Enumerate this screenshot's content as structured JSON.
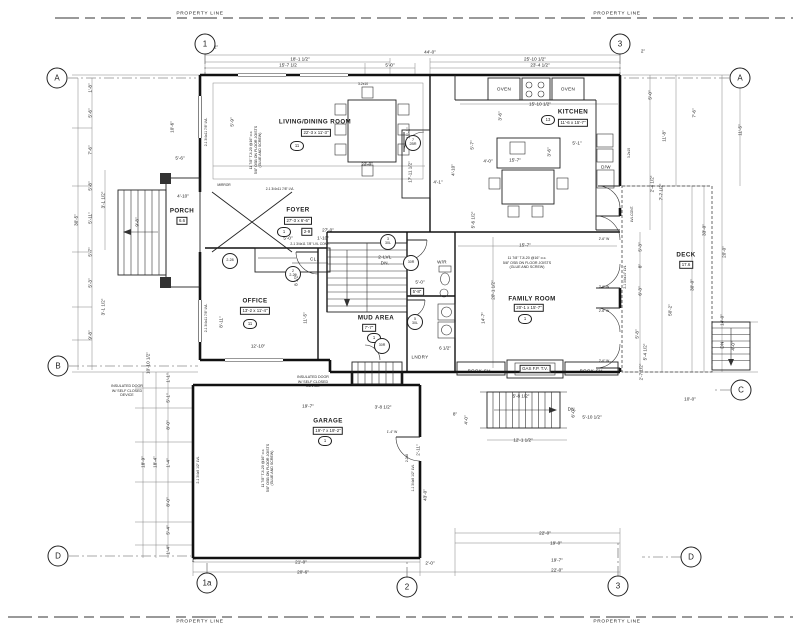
{
  "property_line_label": "PROPERTY LINE",
  "grid_bubbles": [
    {
      "id": "1",
      "x": 205,
      "y": 44
    },
    {
      "id": "3",
      "x": 620,
      "y": 44
    },
    {
      "id": "A",
      "x": 57,
      "y": 78
    },
    {
      "id": "A",
      "x": 740,
      "y": 78
    },
    {
      "id": "B",
      "x": 58,
      "y": 366
    },
    {
      "id": "C",
      "x": 741,
      "y": 390
    },
    {
      "id": "D",
      "x": 58,
      "y": 556
    },
    {
      "id": "D",
      "x": 691,
      "y": 557
    },
    {
      "id": "1a",
      "x": 207,
      "y": 583
    },
    {
      "id": "2",
      "x": 407,
      "y": 587
    },
    {
      "id": "3",
      "x": 618,
      "y": 586
    }
  ],
  "labels": [
    {
      "t": "LIVING/DINING ROOM",
      "x": 315,
      "y": 122,
      "k": "room",
      "n": "room-label-living-dining"
    },
    {
      "t": "22'-3 x 11'-3\"",
      "x": 316,
      "y": 133,
      "k": "box"
    },
    {
      "t": "11",
      "x": 297,
      "y": 146,
      "k": "hex"
    },
    {
      "t": "KITCHEN",
      "x": 573,
      "y": 112,
      "k": "room",
      "n": "room-label-kitchen"
    },
    {
      "t": "11'-6 x 15'-7\"",
      "x": 573,
      "y": 123,
      "k": "box"
    },
    {
      "t": "13",
      "x": 548,
      "y": 120,
      "k": "hex"
    },
    {
      "t": "FOYER",
      "x": 298,
      "y": 210,
      "k": "room",
      "n": "room-label-foyer"
    },
    {
      "t": "27'-3 x 6'-6\"",
      "x": 298,
      "y": 221,
      "k": "box"
    },
    {
      "t": "1",
      "x": 284,
      "y": 232,
      "k": "hex"
    },
    {
      "t": "2-9",
      "x": 307,
      "y": 232,
      "k": "box"
    },
    {
      "t": "OFFICE",
      "x": 255,
      "y": 301,
      "k": "room",
      "n": "room-label-office"
    },
    {
      "t": "13'-2 x 11'-4\"",
      "x": 255,
      "y": 311,
      "k": "box"
    },
    {
      "t": "11",
      "x": 250,
      "y": 324,
      "k": "hex"
    },
    {
      "t": "MUD AREA",
      "x": 376,
      "y": 318,
      "k": "room",
      "n": "room-label-mud-area"
    },
    {
      "t": "7'-7\"",
      "x": 369,
      "y": 328,
      "k": "box"
    },
    {
      "t": "1",
      "x": 374,
      "y": 338,
      "k": "hex"
    },
    {
      "t": "FAMILY ROOM",
      "x": 532,
      "y": 299,
      "k": "room",
      "n": "room-label-family-room"
    },
    {
      "t": "20'-1 x 15'-7\"",
      "x": 529,
      "y": 308,
      "k": "box"
    },
    {
      "t": "1",
      "x": 525,
      "y": 319,
      "k": "hex"
    },
    {
      "t": "GARAGE",
      "x": 328,
      "y": 421,
      "k": "room",
      "n": "room-label-garage"
    },
    {
      "t": "19'-7 x 19'-2\"",
      "x": 328,
      "y": 431,
      "k": "box"
    },
    {
      "t": "1",
      "x": 325,
      "y": 441,
      "k": "hex"
    },
    {
      "t": "DECK",
      "x": 686,
      "y": 255,
      "k": "room",
      "n": "room-label-deck"
    },
    {
      "t": "17.6",
      "x": 686,
      "y": 265,
      "k": "box"
    },
    {
      "t": "PORCH",
      "x": 182,
      "y": 211,
      "k": "room",
      "n": "room-label-porch"
    },
    {
      "t": "6.6",
      "x": 182,
      "y": 221,
      "k": "box"
    },
    {
      "t": "W/R",
      "x": 442,
      "y": 262,
      "k": "fix",
      "n": "room-label-washroom"
    },
    {
      "t": "LNDRY",
      "x": 420,
      "y": 357,
      "k": "fix",
      "n": "room-label-laundry"
    },
    {
      "t": "CL.",
      "x": 314,
      "y": 259,
      "k": "fix",
      "n": "closet-label"
    },
    {
      "t": "OVEN",
      "x": 504,
      "y": 89,
      "k": "fix",
      "n": "oven-label"
    },
    {
      "t": "OVEN",
      "x": 568,
      "y": 89,
      "k": "fix",
      "n": "oven-label"
    },
    {
      "t": "D/W",
      "x": 606,
      "y": 167,
      "k": "fix",
      "n": "dishwasher-label"
    },
    {
      "t": "BOOK SH.",
      "x": 480,
      "y": 371,
      "k": "fix",
      "n": "bookshelf-label"
    },
    {
      "t": "GAS F.P. T.V.",
      "x": 535,
      "y": 369,
      "k": "box",
      "n": "fireplace-label"
    },
    {
      "t": "BOOK SH.",
      "x": 592,
      "y": 371,
      "k": "fix",
      "n": "bookshelf-label"
    },
    {
      "t": "MIRROR",
      "x": 224,
      "y": 186,
      "k": "tiny"
    },
    {
      "t": "2-LVL\nDN.",
      "x": 385,
      "y": 260,
      "k": "fix",
      "n": "stair-label"
    },
    {
      "t": "DN.",
      "x": 572,
      "y": 409,
      "k": "fix",
      "n": "stair-label"
    },
    {
      "t": "DN",
      "x": 722,
      "y": 345,
      "r": -90,
      "k": "fix",
      "n": "deck-stair-label"
    },
    {
      "t": "7\n2BR",
      "x": 413,
      "y": 143,
      "k": "tag",
      "n": "door-tag"
    },
    {
      "t": "2-28",
      "x": 230,
      "y": 261,
      "k": "tag",
      "n": "door-tag"
    },
    {
      "t": "2\n2-29",
      "x": 293,
      "y": 274,
      "k": "tag",
      "n": "door-tag"
    },
    {
      "t": "3\n30L",
      "x": 388,
      "y": 242,
      "k": "tag",
      "n": "door-tag"
    },
    {
      "t": "30R",
      "x": 411,
      "y": 263,
      "k": "tag",
      "n": "door-tag"
    },
    {
      "t": "5\n30L",
      "x": 415,
      "y": 322,
      "k": "tag",
      "n": "door-tag"
    },
    {
      "t": "30R",
      "x": 382,
      "y": 346,
      "k": "tag",
      "n": "door-tag"
    },
    {
      "t": "11 7/8\" TJI-20 @16\" o.c.\n5/8\" OSB ON FLOOR JOISTS\n(GLUE AND SCREW)",
      "x": 527,
      "y": 263,
      "k": "note",
      "n": "floor-joist-note"
    },
    {
      "t": "11 7/8\" TJI-20 @16\" o.c.\n5/8\" OSB ON FLOOR JOISTS\n(GLUE AND SCREW)",
      "x": 256,
      "y": 150,
      "r": -90,
      "k": "note",
      "n": "floor-joist-note"
    },
    {
      "t": "11 7/8\" TJI-20 @16\" o.c.\n5/8\" OSB ON FLOOR JOISTS\n(GLUE AND SCREW)",
      "x": 268,
      "y": 468,
      "r": -90,
      "k": "note",
      "n": "floor-joist-note"
    },
    {
      "t": "INSULATED DOOR\nW/ SELF CLOSED\nDEVICE",
      "x": 127,
      "y": 391,
      "k": "note",
      "n": "insulated-door-note"
    },
    {
      "t": "INSULATED DOOR\nW/ SELF CLOSED\nDEVICE",
      "x": 313,
      "y": 382,
      "k": "note",
      "n": "insulated-door-note"
    },
    {
      "t": "2-1 3/4x11 7/8\" LVL",
      "x": 280,
      "y": 190,
      "k": "tiny"
    },
    {
      "t": "2-1 3/4x11 7/8\" LVL CONT.",
      "x": 310,
      "y": 245,
      "k": "tiny"
    },
    {
      "t": "2-1 3/4x11 7/8\" LVL",
      "x": 207,
      "y": 132,
      "r": -90,
      "k": "tiny"
    },
    {
      "t": "2-1 3/4x11 7/8\" LVL",
      "x": 207,
      "y": 318,
      "r": -90,
      "k": "tiny"
    },
    {
      "t": "2-1 3/4x9 1/2\" LVL",
      "x": 199,
      "y": 470,
      "r": -90,
      "k": "tiny"
    },
    {
      "t": "1-1 3/4x9 1/2\" LVL",
      "x": 414,
      "y": 478,
      "r": -90,
      "k": "tiny"
    },
    {
      "t": "2-1 3/4x14\" LVL",
      "x": 626,
      "y": 277,
      "r": -90,
      "k": "tiny"
    },
    {
      "t": "LVL CONT.",
      "x": 633,
      "y": 214,
      "r": -90,
      "k": "tiny"
    },
    {
      "t": "3-2x10",
      "x": 363,
      "y": 85,
      "k": "tiny"
    },
    {
      "t": "3-2x10",
      "x": 630,
      "y": 153,
      "r": -90,
      "k": "tiny"
    },
    {
      "t": "2-2x8",
      "x": 408,
      "y": 458,
      "r": -90,
      "k": "tiny"
    },
    {
      "t": "1'-4\" W",
      "x": 392,
      "y": 433,
      "k": "tiny"
    },
    {
      "t": "2'-6\" W",
      "x": 604,
      "y": 240,
      "k": "tiny"
    },
    {
      "t": "2'-6\" W",
      "x": 604,
      "y": 288,
      "k": "tiny"
    },
    {
      "t": "2'-6\" W",
      "x": 604,
      "y": 312,
      "k": "tiny"
    },
    {
      "t": "2'-6\" W",
      "x": 604,
      "y": 362,
      "k": "tiny"
    },
    {
      "t": "44'-0\"",
      "x": 430,
      "y": 52
    },
    {
      "t": "25'-10 1/2\"",
      "x": 535,
      "y": 59
    },
    {
      "t": "23'-4 1/2\"",
      "x": 540,
      "y": 65
    },
    {
      "t": "18'-1 1/2\"",
      "x": 300,
      "y": 59
    },
    {
      "t": "15'-7 1/2",
      "x": 288,
      "y": 65
    },
    {
      "t": "5'-0\"",
      "x": 390,
      "y": 65
    },
    {
      "t": "2\"",
      "x": 216,
      "y": 47
    },
    {
      "t": "2\"",
      "x": 643,
      "y": 51
    },
    {
      "t": "30'-5\"",
      "x": 76,
      "y": 220,
      "r": -90
    },
    {
      "t": "1'-8\"",
      "x": 90,
      "y": 88,
      "r": -90
    },
    {
      "t": "5'-6\"",
      "x": 90,
      "y": 113,
      "r": -90
    },
    {
      "t": "7'-6\"",
      "x": 90,
      "y": 150,
      "r": -90
    },
    {
      "t": "5'-8\"",
      "x": 90,
      "y": 186,
      "r": -90
    },
    {
      "t": "5'-11\"",
      "x": 90,
      "y": 218,
      "r": -90
    },
    {
      "t": "5'-7\"",
      "x": 90,
      "y": 252,
      "r": -90
    },
    {
      "t": "5'-3\"",
      "x": 90,
      "y": 283,
      "r": -90
    },
    {
      "t": "9'-8\"",
      "x": 90,
      "y": 335,
      "r": -90
    },
    {
      "t": "3'-1 1/2\"",
      "x": 103,
      "y": 200,
      "r": -90
    },
    {
      "t": "3'-1 1/2\"",
      "x": 103,
      "y": 307,
      "r": -90
    },
    {
      "t": "10'-6\"",
      "x": 172,
      "y": 127,
      "r": -90
    },
    {
      "t": "5'-6\"",
      "x": 180,
      "y": 158
    },
    {
      "t": "4'-10\"",
      "x": 183,
      "y": 196
    },
    {
      "t": "9'-8\"",
      "x": 137,
      "y": 222,
      "r": -90
    },
    {
      "t": "18'-9\"",
      "x": 143,
      "y": 462,
      "r": -90
    },
    {
      "t": "18'-4\"",
      "x": 155,
      "y": 462,
      "r": -90
    },
    {
      "t": "1'-1\"",
      "x": 168,
      "y": 378,
      "r": -90
    },
    {
      "t": "5'-1\"",
      "x": 168,
      "y": 398,
      "r": -90
    },
    {
      "t": "8'-0\"",
      "x": 168,
      "y": 425,
      "r": -90
    },
    {
      "t": "1'-4\"",
      "x": 168,
      "y": 463,
      "r": -90
    },
    {
      "t": "8'-0\"",
      "x": 168,
      "y": 502,
      "r": -90
    },
    {
      "t": "5'-4\"",
      "x": 168,
      "y": 530,
      "r": -90
    },
    {
      "t": "1'-4\"",
      "x": 168,
      "y": 550,
      "r": -90
    },
    {
      "t": "11'-5\"",
      "x": 740,
      "y": 130,
      "r": -90
    },
    {
      "t": "7'-6\"",
      "x": 694,
      "y": 113,
      "r": -90
    },
    {
      "t": "11'-8\"",
      "x": 664,
      "y": 136,
      "r": -90
    },
    {
      "t": "5'-0\"",
      "x": 650,
      "y": 95,
      "r": -90
    },
    {
      "t": "2'-4 1/2\"",
      "x": 652,
      "y": 184,
      "r": -90
    },
    {
      "t": "7'-7 1/2\"",
      "x": 661,
      "y": 192,
      "r": -90
    },
    {
      "t": "33'-0\"",
      "x": 704,
      "y": 230,
      "r": -90
    },
    {
      "t": "20'-0\"",
      "x": 724,
      "y": 252,
      "r": -90
    },
    {
      "t": "30'-0\"",
      "x": 692,
      "y": 285,
      "r": -90
    },
    {
      "t": "50'-2\"",
      "x": 670,
      "y": 310,
      "r": -90
    },
    {
      "t": "14'-0\"",
      "x": 722,
      "y": 320,
      "r": -90
    },
    {
      "t": "5'-3\"",
      "x": 640,
      "y": 247,
      "r": -90
    },
    {
      "t": "8\"",
      "x": 640,
      "y": 266,
      "r": -90
    },
    {
      "t": "6'-3\"",
      "x": 640,
      "y": 291,
      "r": -90
    },
    {
      "t": "5'-8\"",
      "x": 637,
      "y": 334,
      "r": -90
    },
    {
      "t": "5'-4 1/2\"",
      "x": 645,
      "y": 352,
      "r": -90
    },
    {
      "t": "2'-7 1/2\"",
      "x": 641,
      "y": 372,
      "r": -90
    },
    {
      "t": "4'-0\"",
      "x": 733,
      "y": 346,
      "r": -90
    },
    {
      "t": "10'-0\"",
      "x": 690,
      "y": 399
    },
    {
      "t": "21'-0\"",
      "x": 301,
      "y": 562
    },
    {
      "t": "20'-6\"",
      "x": 303,
      "y": 572
    },
    {
      "t": "2\"",
      "x": 194,
      "y": 560
    },
    {
      "t": "2'-0\"",
      "x": 430,
      "y": 563
    },
    {
      "t": "22'-0\"",
      "x": 545,
      "y": 533
    },
    {
      "t": "19'-0\"",
      "x": 556,
      "y": 543
    },
    {
      "t": "19'-7\"",
      "x": 557,
      "y": 560
    },
    {
      "t": "22'-0\"",
      "x": 557,
      "y": 570
    },
    {
      "t": "12'-1 1/2\"",
      "x": 523,
      "y": 440
    },
    {
      "t": "5'-10 1/2\"",
      "x": 592,
      "y": 417
    },
    {
      "t": "5'-8 1/2\"",
      "x": 521,
      "y": 396
    },
    {
      "t": "4'-0\"",
      "x": 466,
      "y": 420,
      "r": -90
    },
    {
      "t": "6'-0\"",
      "x": 573,
      "y": 413,
      "r": -90
    },
    {
      "t": "8\"",
      "x": 455,
      "y": 414
    },
    {
      "t": "22'-0\"",
      "x": 367,
      "y": 164
    },
    {
      "t": "17'-11 1/2\"",
      "x": 410,
      "y": 172,
      "r": -90
    },
    {
      "t": "11'-1\"",
      "x": 408,
      "y": 133,
      "r": -90
    },
    {
      "t": "5'-9\"",
      "x": 232,
      "y": 122,
      "r": -90
    },
    {
      "t": "15'-10 1/2\"",
      "x": 540,
      "y": 104
    },
    {
      "t": "15'-7\"",
      "x": 515,
      "y": 160
    },
    {
      "t": "5'-1\"",
      "x": 577,
      "y": 143
    },
    {
      "t": "4'-0\"",
      "x": 488,
      "y": 161
    },
    {
      "t": "3'-6\"",
      "x": 500,
      "y": 116,
      "r": -90
    },
    {
      "t": "3'-6\"",
      "x": 549,
      "y": 152,
      "r": -90
    },
    {
      "t": "5'-0\"",
      "x": 288,
      "y": 238
    },
    {
      "t": "1'-10\"",
      "x": 323,
      "y": 238
    },
    {
      "t": "27'-0\"",
      "x": 328,
      "y": 230
    },
    {
      "t": "12'-10\"",
      "x": 258,
      "y": 346
    },
    {
      "t": "8'-11\"",
      "x": 221,
      "y": 322,
      "r": -90
    },
    {
      "t": "11'-5\"",
      "x": 305,
      "y": 318,
      "r": -90
    },
    {
      "t": "8 1/2\"",
      "x": 296,
      "y": 280,
      "r": -90
    },
    {
      "t": "10'-10 1/2\"",
      "x": 148,
      "y": 363,
      "r": -90
    },
    {
      "t": "5'-6 1/2\"",
      "x": 473,
      "y": 220,
      "r": -90
    },
    {
      "t": "6 1/2\"",
      "x": 445,
      "y": 348
    },
    {
      "t": "4'-10\"",
      "x": 453,
      "y": 170,
      "r": -90
    },
    {
      "t": "4'-1\"",
      "x": 438,
      "y": 182
    },
    {
      "t": "5'-7\"",
      "x": 472,
      "y": 145,
      "r": -90
    },
    {
      "t": "15'-7\"",
      "x": 525,
      "y": 245
    },
    {
      "t": "20'-1 1/2\"",
      "x": 493,
      "y": 290,
      "r": -90
    },
    {
      "t": "14'-7\"",
      "x": 483,
      "y": 318,
      "r": -90
    },
    {
      "t": "5'-0\"",
      "x": 420,
      "y": 282
    },
    {
      "t": "5'-8\"",
      "x": 417,
      "y": 292,
      "k": "box"
    },
    {
      "t": "19'-7\"",
      "x": 308,
      "y": 406
    },
    {
      "t": "3'-8 1/2\"",
      "x": 383,
      "y": 407
    },
    {
      "t": "43'-0\"",
      "x": 425,
      "y": 495,
      "r": -90
    },
    {
      "t": "2'-11\"",
      "x": 418,
      "y": 450,
      "r": -90
    }
  ]
}
